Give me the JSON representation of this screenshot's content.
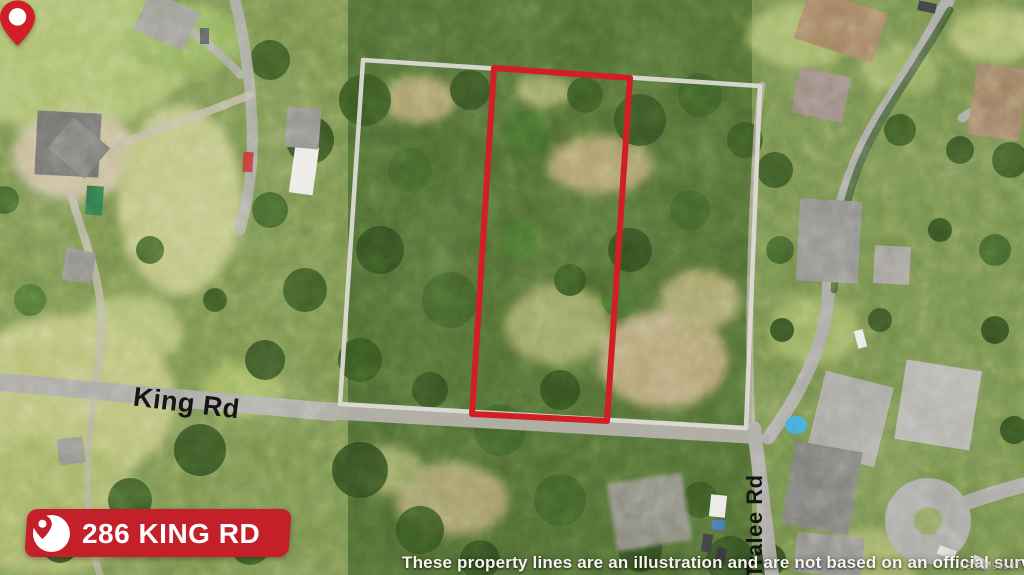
{
  "address_badge": {
    "text": "286 KING RD",
    "background_color": "#c3202a",
    "text_color": "#ffffff",
    "icon": "map-pin-icon"
  },
  "road_labels": {
    "king_rd": "King Rd",
    "tralee_rd": "Tralee Rd"
  },
  "disclaimer_text": "These property lines are an illustration and are not based on an official survey.",
  "watermark_text": "LS®1099587",
  "boundary_colors": {
    "subject_parcel_line": "#d21f26",
    "outer_parcel_line": "#dbdad5"
  },
  "marker": {
    "color": "#d21f26",
    "type": "location-pin"
  }
}
